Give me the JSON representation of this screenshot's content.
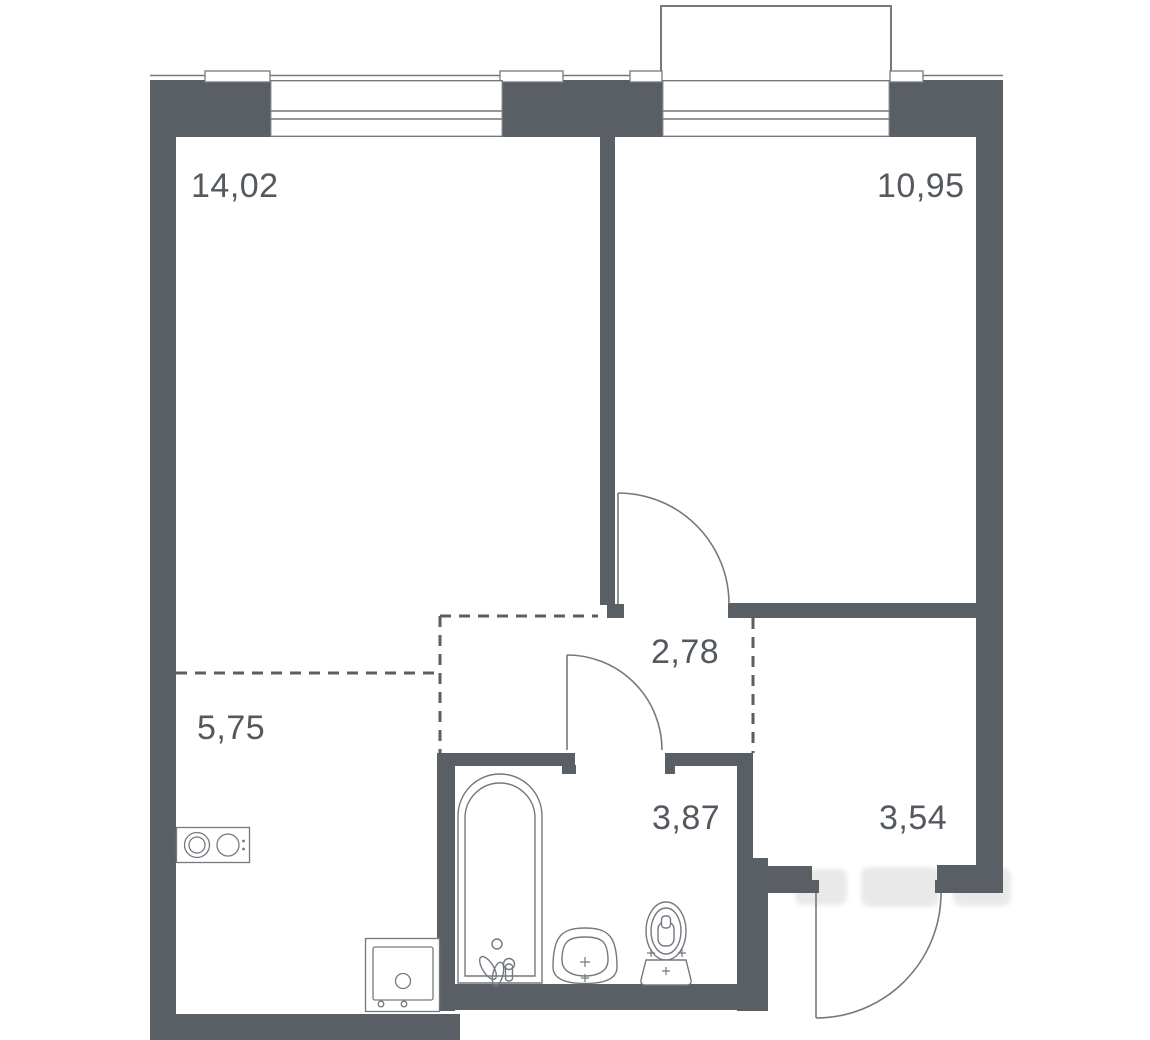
{
  "plan": {
    "rooms": [
      {
        "id": "living-room",
        "area": "14,02"
      },
      {
        "id": "bedroom",
        "area": "10,95"
      },
      {
        "id": "hallway",
        "area": "2,78"
      },
      {
        "id": "kitchen-niche",
        "area": "5,75"
      },
      {
        "id": "bathroom",
        "area": "3,87"
      },
      {
        "id": "entry",
        "area": "3,54"
      }
    ],
    "fixtures": [
      "bathtub",
      "sink",
      "toilet",
      "stove",
      "washing-machine",
      "balcony",
      "window",
      "window",
      "door-bedroom",
      "door-bathroom",
      "door-entry"
    ],
    "colors": {
      "wall": "#5A5F66",
      "line": "#74797F",
      "text": "#54585F",
      "background": "#FFFFFF"
    }
  }
}
